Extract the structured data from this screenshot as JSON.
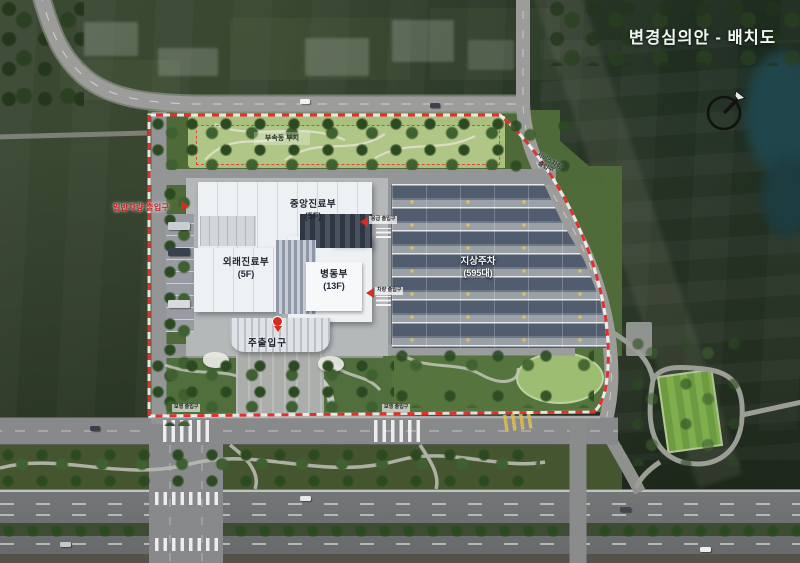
{
  "header": {
    "title": "변경심의안 - 배치도"
  },
  "site_plan": {
    "annex_site": {
      "label": "부속동 부지"
    },
    "buildings": {
      "central": {
        "name": "중앙진료부",
        "floors": "(5F)"
      },
      "outpatient": {
        "name": "외래진료부",
        "floors": "(5F)"
      },
      "ward": {
        "name": "병동부",
        "floors": "(13F)"
      }
    },
    "parking": {
      "name": "지상주차",
      "capacity": "(595대)"
    },
    "entrances": {
      "main": {
        "label": "주출입구"
      },
      "general_vehicle": {
        "label": "일반차량 출입구"
      },
      "emergency": {
        "label": "응급 출입구"
      },
      "vehicle": {
        "label": "차량 출입구"
      },
      "service": {
        "line1": "서비스차량",
        "line2": "출입구"
      },
      "pedestrian_west": {
        "label": "보행 출입구"
      },
      "pedestrian_east": {
        "label": "보행 출입구"
      }
    }
  },
  "colors": {
    "boundary_red": "#e03030",
    "accent_red": "#d92b20",
    "title_white": "#f2f5f2"
  }
}
